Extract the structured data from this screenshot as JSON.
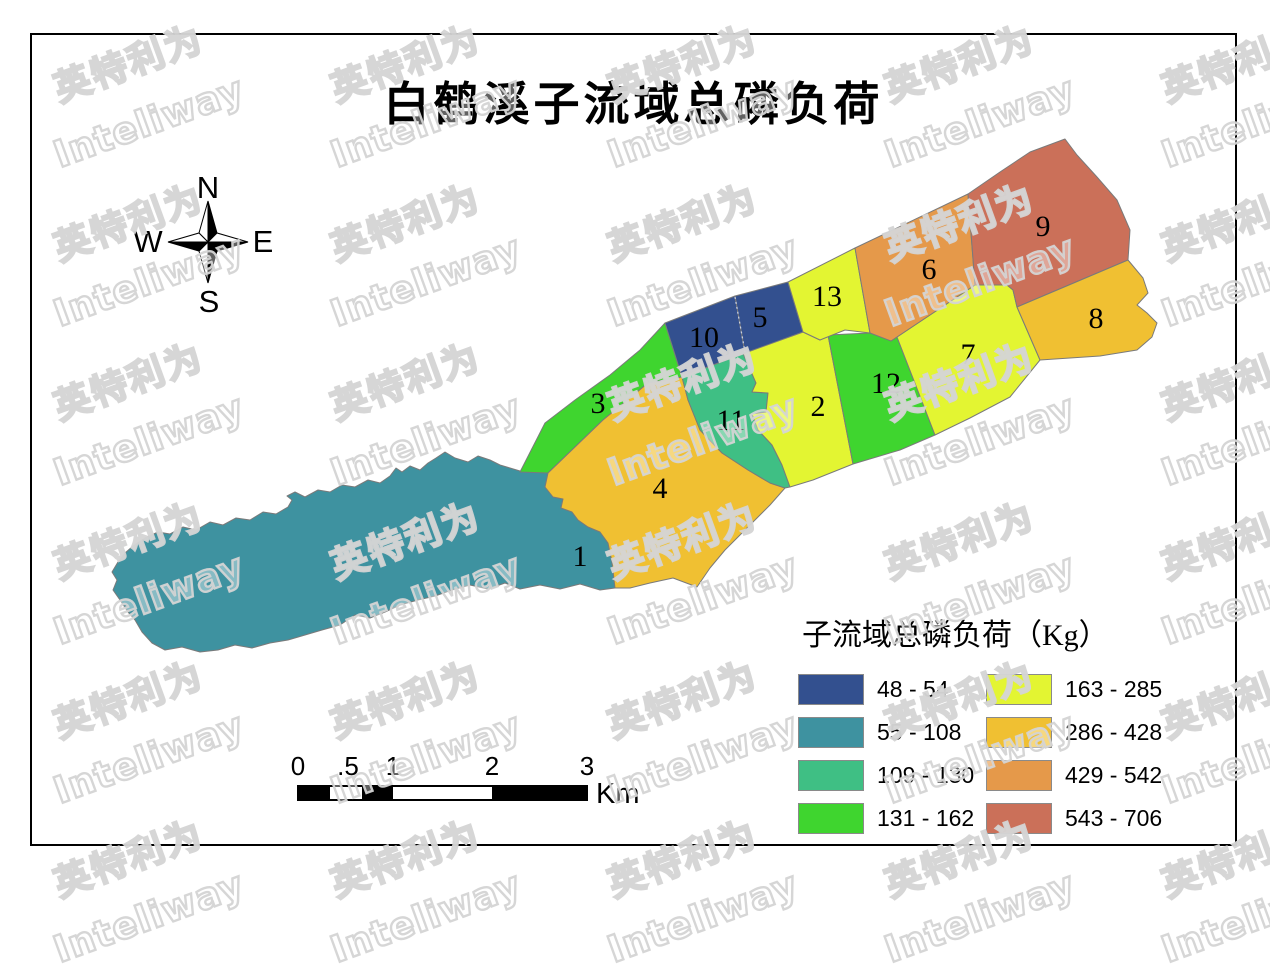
{
  "title": "白鹤溪子流域总磷负荷",
  "compass": {
    "n": "N",
    "e": "E",
    "s": "S",
    "w": "W"
  },
  "legend": {
    "title": "子流域总磷负荷（Kg）",
    "classes": [
      {
        "range": "48 - 54",
        "color": "#33508F"
      },
      {
        "range": "55 - 108",
        "color": "#3E92A0"
      },
      {
        "range": "109 - 130",
        "color": "#3FBF84"
      },
      {
        "range": "131 - 162",
        "color": "#3FD52F"
      },
      {
        "range": "163 - 285",
        "color": "#E3F532"
      },
      {
        "range": "286 - 428",
        "color": "#F0C032"
      },
      {
        "range": "429 - 542",
        "color": "#E5994A"
      },
      {
        "range": "543 - 706",
        "color": "#CB7059"
      }
    ]
  },
  "scalebar": {
    "labels": [
      "0",
      ".5",
      "1",
      "2",
      "3"
    ],
    "unit": "Km"
  },
  "watermark": {
    "cn": "英特利为",
    "en": "Inteliway"
  },
  "map": {
    "regions": [
      {
        "id": "1",
        "range": "55 - 108",
        "color": "#3E92A0",
        "label": {
          "x": 580,
          "y": 566
        },
        "points": "445,452 455,458 468,462 478,456 490,460 500,465 510,468 520,471 548,473 545,487 553,497 563,499 561,508 572,512 578,520 588,527 600,532 608,543 612,562 615,588 600,590 580,584 560,589 540,585 520,589 505,583 488,589 470,585 452,590 435,596 418,600 400,605 385,612 370,618 355,615 340,625 322,630 305,635 288,640 270,643 252,648 235,645 218,650 200,652 182,647 165,650 152,643 142,632 135,620 128,612 120,600 113,590 117,580 112,572 118,562 125,553 133,546 145,538 158,532 170,534 183,527 196,530 210,522 223,525 236,518 250,520 263,512 276,514 288,507 292,500 287,496 295,492 305,497 318,490 330,492 342,485 355,487 368,480 380,483 390,476 396,468 402,472 410,466 420,470 428,463 436,458"
      },
      {
        "id": "3",
        "range": "131 - 162",
        "color": "#3FD52F",
        "label": {
          "x": 598,
          "y": 413
        },
        "points": "520,472 545,423 575,400 610,375 640,350 665,323 682,377 648,383 603,420 548,473"
      },
      {
        "id": "4",
        "range": "286 - 428",
        "color": "#F0C032",
        "label": {
          "x": 660,
          "y": 498
        },
        "points": "548,473 603,420 648,383 682,377 688,400 700,430 722,453 748,470 770,483 785,488 770,505 750,525 725,550 710,568 697,587 673,578 650,583 630,588 615,588 612,562 608,543 600,532 588,527 578,520 572,512 561,508 563,499 553,497 545,487"
      },
      {
        "id": "11",
        "range": "109 - 130",
        "color": "#3FBF84",
        "label": {
          "x": 731,
          "y": 430
        },
        "points": "682,377 743,353 756,383 752,392 768,393 766,412 752,414 758,430 772,445 782,465 790,487 785,488 770,483 748,470 722,453 700,430 688,400"
      },
      {
        "id": "2",
        "range": "163 - 285",
        "color": "#E3F532",
        "label": {
          "x": 818,
          "y": 416
        },
        "points": "743,353 803,332 820,340 828,335 853,464 813,480 790,487 782,465 772,445 758,430 752,414 766,412 768,393 752,392 756,383"
      },
      {
        "id": "12",
        "range": "131 - 162",
        "color": "#3FD52F",
        "label": {
          "x": 886,
          "y": 393
        },
        "points": "828,335 870,333 897,337 935,435 900,450 853,464"
      },
      {
        "id": "7",
        "range": "163 - 285",
        "color": "#E3F532",
        "label": {
          "x": 968,
          "y": 364
        },
        "points": "891,341 975,285 1007,285 1013,290 1017,307 1040,360 1010,397 970,418 935,435 897,337"
      },
      {
        "id": "10",
        "range": "48 - 54",
        "color": "#33508F",
        "label": {
          "x": 704,
          "y": 347
        },
        "points": "665,323 735,296 745,353 705,368 682,377"
      },
      {
        "id": "5",
        "range": "48 - 54",
        "color": "#33508F",
        "label": {
          "x": 760,
          "y": 327
        },
        "points": "735,296 788,282 803,332 745,353"
      },
      {
        "id": "13",
        "range": "163 - 285",
        "color": "#E3F532",
        "label": {
          "x": 827,
          "y": 306
        },
        "points": "788,282 855,248 870,333 845,330 820,340 803,332"
      },
      {
        "id": "6",
        "range": "429 - 542",
        "color": "#E5994A",
        "label": {
          "x": 929,
          "y": 279
        },
        "points": "855,248 968,194 975,285 891,341 870,333"
      },
      {
        "id": "9",
        "range": "543 - 706",
        "color": "#CB7059",
        "label": {
          "x": 1043,
          "y": 236
        },
        "points": "968,194 1000,172 1030,152 1065,139 1077,155 1097,177 1117,200 1130,230 1128,260 1017,307 1013,290 1007,285 975,285"
      },
      {
        "id": "8",
        "range": "286 - 428",
        "color": "#F0C032",
        "label": {
          "x": 1096,
          "y": 328
        },
        "points": "1017,307 1128,260 1143,278 1148,293 1137,305 1147,313 1157,323 1152,337 1137,350 1100,356 1040,360"
      }
    ]
  }
}
